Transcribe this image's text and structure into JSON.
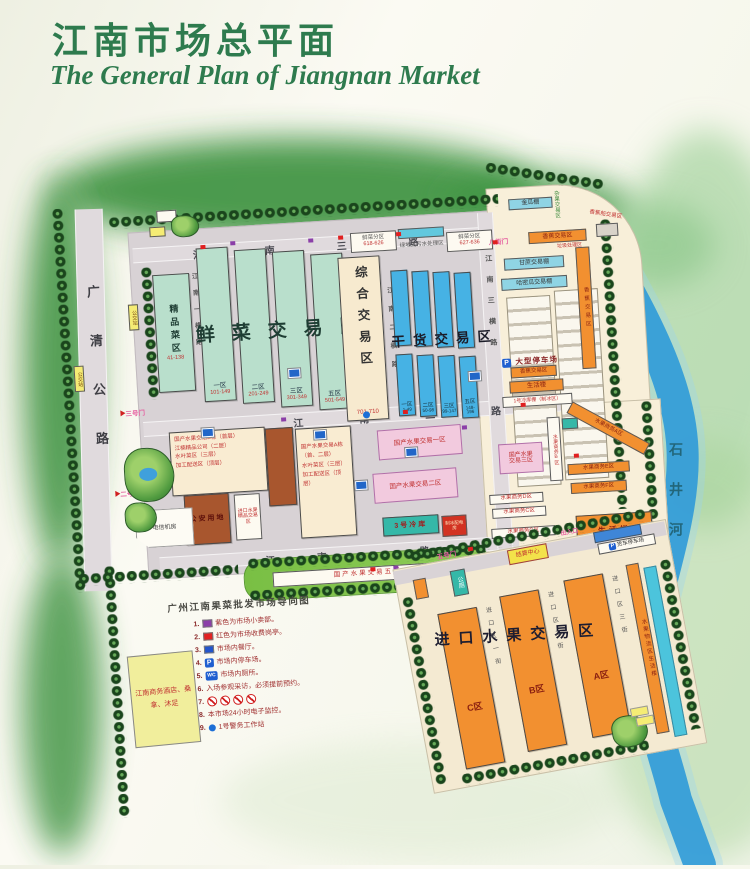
{
  "title": {
    "cn": "江南市场总平面",
    "en": "The General Plan of Jiangnan Market"
  },
  "river": {
    "name": "石井河"
  },
  "roads": {
    "guangqing": "广清公路",
    "jn3": "江南三路",
    "jn2": "江南二路",
    "jn1": "江南一路",
    "heng1": "江南一横路",
    "heng2": "江南二横路",
    "heng3": "江南三横路",
    "d1": "D区一街",
    "d2": "D区二街",
    "d3": "D区三街",
    "imp1": "进口区一街",
    "imp2": "进口区二街",
    "imp3": "进口区三街"
  },
  "gates": {
    "g2": "二号门",
    "g3": "三号门",
    "g5": "五号门",
    "g8": "八街门"
  },
  "bus_stop": "公交站",
  "icons": {
    "parking": "P",
    "toilet": "WC"
  },
  "zones": {
    "premium": {
      "name": "精品菜区",
      "range": "41-138"
    },
    "fresh": {
      "title": "鲜菜交易区",
      "b": [
        {
          "n": "一区",
          "r": "101-149"
        },
        {
          "n": "二区",
          "r": "201-249"
        },
        {
          "n": "三区",
          "r": "301-349"
        },
        {
          "n": "五区",
          "r": "501-549"
        }
      ]
    },
    "comprehensive": {
      "name": "综合交易区",
      "range": "701-710"
    },
    "dry": {
      "title": "干货交易区",
      "b": [
        {
          "n": "一区",
          "r": "1-49"
        },
        {
          "n": "二区",
          "r": "50-98"
        },
        {
          "n": "三区",
          "r": "99-147"
        },
        {
          "n": "五区",
          "r": "148-196"
        }
      ]
    }
  },
  "north_strip": {
    "sub1": "鲜菜分区",
    "sub1_range": "618-626",
    "sewage": "绿地式污水处理区",
    "sub2": "鲜菜分区",
    "sub2_range": "627-636"
  },
  "east": {
    "melon_shed": "金瓜棚",
    "mixed_fruit": "杂果交易区",
    "banana_top": "香蕉交易区",
    "garbage": "垃圾处理区",
    "banana_boat": "香蕉船交易区",
    "sugarcane": "甘蔗交易棚",
    "hami_melon": "哈密瓜交易棚",
    "banana_side": "香蕉交易区",
    "parking": "大型停车场",
    "banana_low": "香蕉交易区",
    "living": "生活楼",
    "cold_shed": "1号冷库棚（制冰区）"
  },
  "southeast": {
    "domestic3a": "国产水果",
    "domestic3b": "交易三区",
    "biz_a": "水果商务A区",
    "biz_b": "水果商务B区",
    "biz_c": "水果商务C区",
    "biz_d": "水果商务D区",
    "biz_e": "水果商务E区",
    "biz_f": "水果商务F区",
    "biz_g": "水果商务G区",
    "living": "生活楼"
  },
  "central": {
    "b_lines": [
      "国产水果交易B栋（首层）",
      "江楠精品公司（二层）",
      "水叶菜区（三层）",
      "加工配送区（顶层）"
    ],
    "a_lines": [
      "国产水果交易A栋（首、二层）",
      "水叶菜区（三层）",
      "加工配送区（顶层）"
    ],
    "police": "公安用地",
    "import_premium": "进口水果精品交易区",
    "domestic1": "国产水果交易一区",
    "domestic2": "国产水果交易二区",
    "cold3": "3号冷库",
    "ice": "制冰配电房",
    "telecom": "电信机房",
    "domestic5": "国产水果交易五区"
  },
  "import": {
    "title": "进口水果交易区",
    "c": "C区",
    "b": "B区",
    "a": "A区",
    "settlement": "结算中心",
    "entrance": "出入口",
    "truck_parking": "货车停车场",
    "toilet": "公厕",
    "logistics": "水果物流区生活楼"
  },
  "legend": {
    "title": "广州江南果菜批发市场导向图",
    "items": [
      {
        "num": "1.",
        "text": "紫色为市场小卖部。"
      },
      {
        "num": "2.",
        "text": "红色为市场收费岗亭。"
      },
      {
        "num": "3.",
        "text": "市场内餐厅。"
      },
      {
        "num": "4.",
        "text": "市场内停车场。"
      },
      {
        "num": "5.",
        "text": "市场内厕所。"
      },
      {
        "num": "6.",
        "text": "入场参观采访，必须提前预约。"
      },
      {
        "num": "7.",
        "text": ""
      },
      {
        "num": "8.",
        "text": "本市场24小时电子监控。"
      },
      {
        "num": "9.",
        "text": "1号警务工作站"
      }
    ],
    "hotel": "江南商务酒店、桑拿、沐足"
  },
  "colors": {
    "title_green": "#2e7b4e",
    "road_gray": "#d8d2d5",
    "building_green": "#b9dfcc",
    "building_blue": "#46b2e4",
    "orange": "#f29030",
    "pink": "#f2cade",
    "teal": "#35b8a8",
    "cream": "#f8efd9",
    "river_blue": "#2f9ad8",
    "legend_red": "#a03030"
  }
}
